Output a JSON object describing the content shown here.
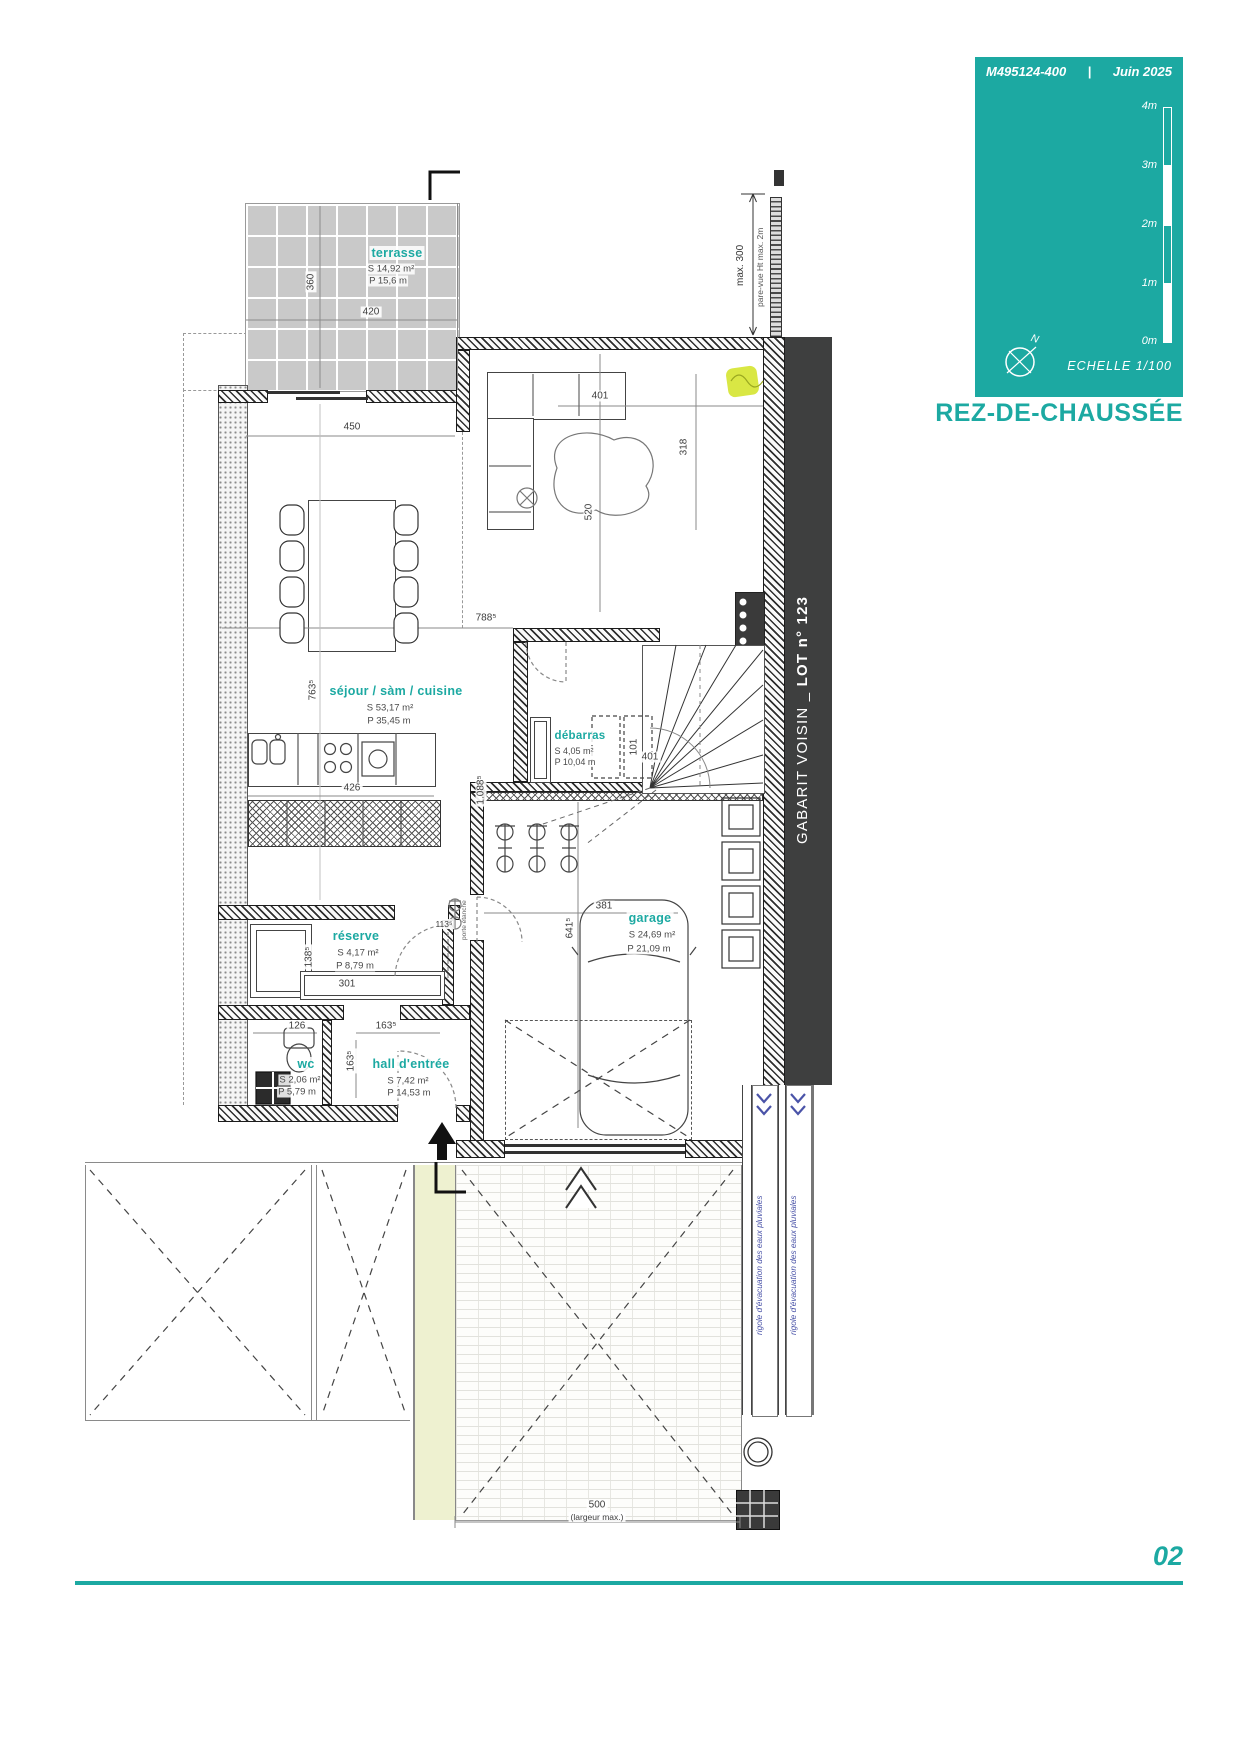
{
  "meta": {
    "doc_ref": "M495124-400",
    "separator": "|",
    "date": "Juin 2025"
  },
  "title_block": {
    "scale_label": "ECHELLE  1/100",
    "north": "N",
    "ticks": [
      "4m",
      "3m",
      "2m",
      "1m",
      "0m"
    ]
  },
  "floor_title": "REZ-DE-CHAUSSÉE",
  "page_number": "02",
  "rooms": {
    "terrasse": {
      "name": "terrasse",
      "s": "S  14,92 m²",
      "p": "P  15,6 m"
    },
    "sejour": {
      "name": "séjour / sàm / cuisine",
      "s": "S  53,17 m²",
      "p": "P  35,45 m"
    },
    "debarras": {
      "name": "débarras",
      "s": "S  4,05 m²",
      "p": "P  10,04 m"
    },
    "garage": {
      "name": "garage",
      "s": "S  24,69 m²",
      "p": "P  21,09 m"
    },
    "reserve": {
      "name": "réserve",
      "s": "S  4,17 m²",
      "p": "P  8,79 m"
    },
    "wc": {
      "name": "wc",
      "s": "S  2,06 m²",
      "p": "P  5,79 m"
    },
    "hall": {
      "name": "hall d'entrée",
      "s": "S  7,42 m²",
      "p": "P  14,53 m"
    }
  },
  "dims": {
    "t_w": "420",
    "t_h": "360",
    "s_w": "450",
    "s_w2": "788⁵",
    "s_h": "763⁵",
    "k_w": "426",
    "l_w": "401",
    "l_h": "318",
    "l_h2": "520",
    "st_w": "101",
    "deb_w": "401",
    "depth": "1.088⁵",
    "r_h": "138⁵",
    "bench": "301",
    "wc_w": "126",
    "hall_w": "163⁵",
    "hall_h": "163⁵",
    "door": "113⁵",
    "g_w": "381",
    "g_h": "641⁵",
    "fence": "max. 300",
    "dw": "500",
    "dw_note": "(largeur max.)"
  },
  "annotations": {
    "gabarit_prefix": "GABARIT VOISIN _ ",
    "gabarit_lot": "LOT n° 123",
    "pare_vue": "pare-vue Ht max. 2m",
    "rigole": "rigole d'évacuation des eaux pluviales",
    "porte": "porte étanche"
  },
  "colors": {
    "accent": "#1CA9A2",
    "band": "#3E3F3F",
    "blue": "#4A53A8",
    "highlight": "#D9E744"
  }
}
